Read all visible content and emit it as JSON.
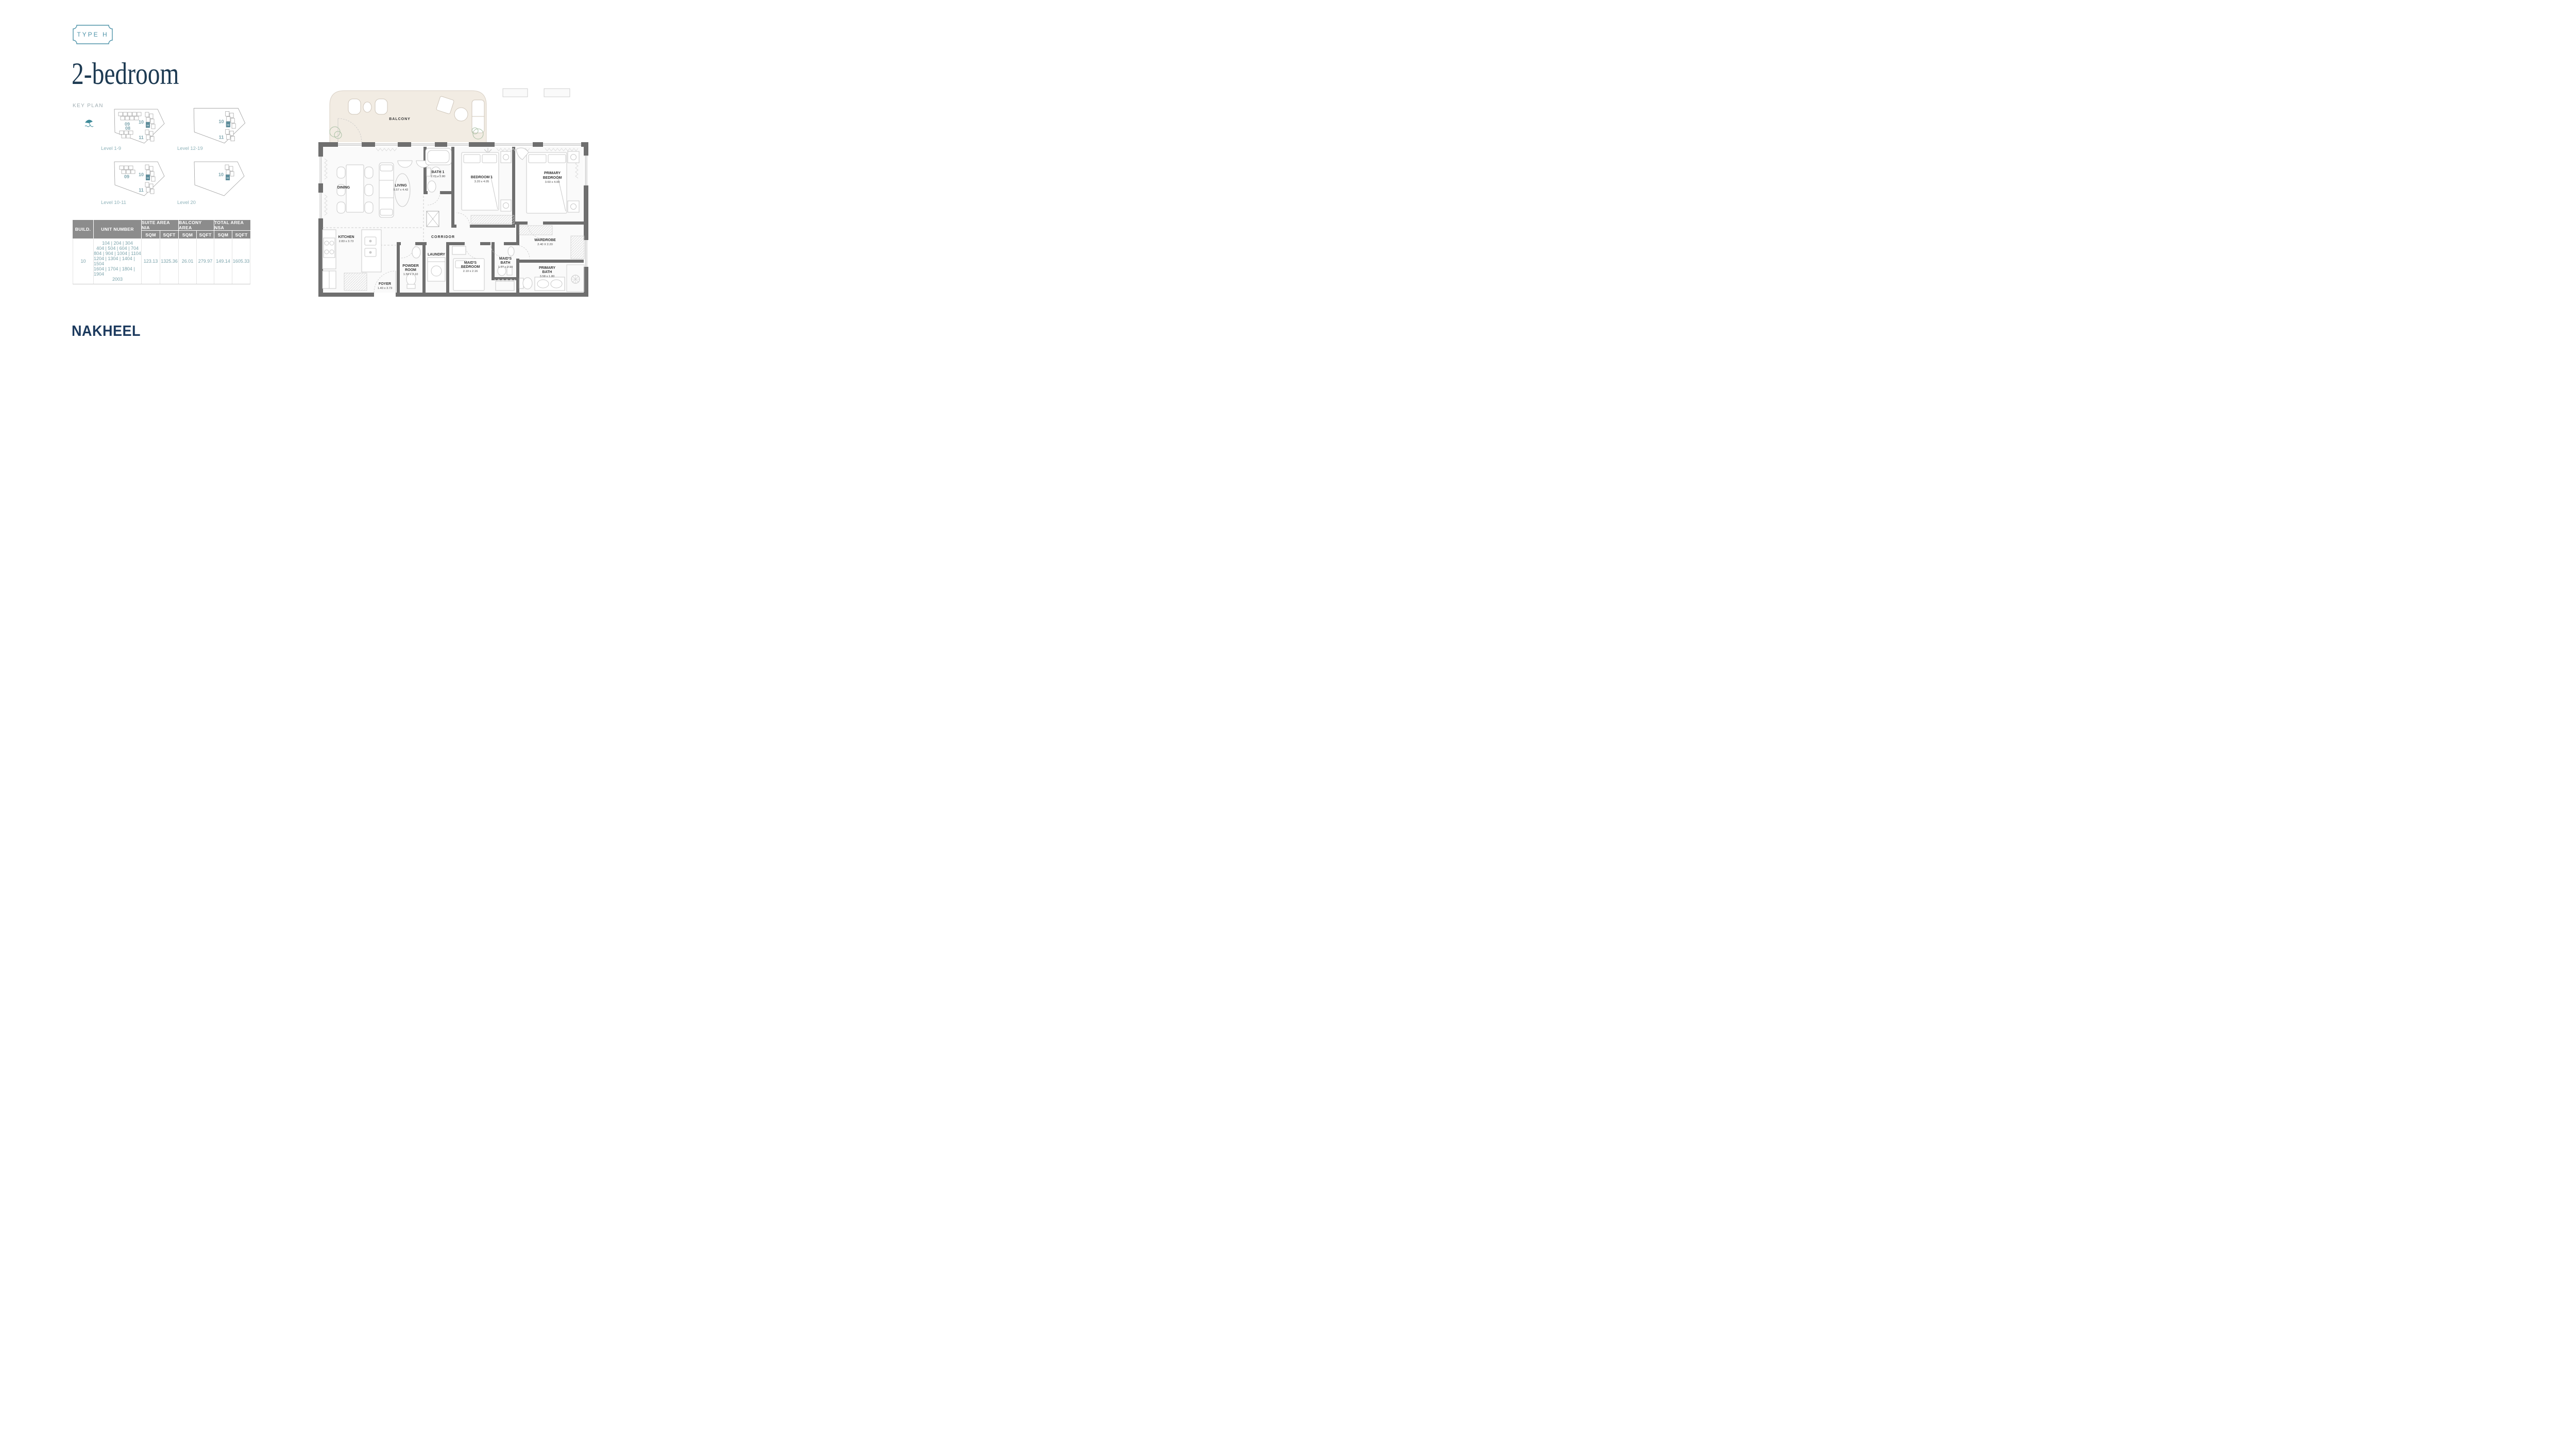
{
  "badge": {
    "label": "TYPE H"
  },
  "title": "2-bedroom",
  "key_plan": {
    "heading": "KEY PLAN",
    "plans": [
      {
        "level_label": "Level 1-9",
        "buildings": [
          "09",
          "10",
          "08",
          "11"
        ],
        "unit": "04"
      },
      {
        "level_label": "Level 12-19",
        "buildings": [
          "10",
          "11"
        ],
        "unit": "04"
      },
      {
        "level_label": "Level 10-11",
        "buildings": [
          "09",
          "10",
          "11"
        ],
        "unit": "04"
      },
      {
        "level_label": "Level 20",
        "buildings": [
          "10"
        ],
        "unit": "03"
      }
    ]
  },
  "table": {
    "build_header": "BUILD.",
    "unit_header": "UNIT NUMBER",
    "groups": [
      "SUITE AREA NIA",
      "BALCONY AREA",
      "TOTAL AREA NSA"
    ],
    "sqm": "SQM",
    "sqft": "SQFT",
    "row": {
      "build": "10",
      "unit_lines": [
        "104 | 204 | 304",
        "404 | 504 | 604 | 704",
        "804 | 904 | 1004 | 1104",
        "1204 | 1304 | 1404 | 1504",
        "1604 | 1704 | 1804 | 1904",
        "2003"
      ],
      "suite_sqm": "123.13",
      "suite_sqft": "1325.36",
      "balcony_sqm": "26.01",
      "balcony_sqft": "279.97",
      "total_sqm": "149.14",
      "total_sqft": "1605.33"
    }
  },
  "floorplan": {
    "rooms": {
      "balcony": {
        "line1": "BALCONY"
      },
      "dining": {
        "line1": "DINING"
      },
      "living": {
        "line1": "LIVING",
        "dims": "5.57 x 4.42"
      },
      "bath1": {
        "line1": "BATH 1",
        "dims": "1.70 x 2.80"
      },
      "bedroom1": {
        "line1": "BEDROOM 1",
        "dims": "3.20 x 4.05"
      },
      "primary_bedroom": {
        "line1": "PRIMARY",
        "line2": "BEDROOM",
        "dims": "3.60 x 4.00"
      },
      "kitchen": {
        "line1": "KITCHEN",
        "dims": "2.83 x 3.73"
      },
      "foyer": {
        "line1": "FOYER",
        "dims": "1.40 x 3.73"
      },
      "powder": {
        "line1": "POWDER",
        "line2": "ROOM",
        "dims": "1.50 x 2.10"
      },
      "laundry": {
        "line1": "LAUNDRY"
      },
      "maid_bedroom": {
        "line1": "MAID'S",
        "line2": "BEDROOM",
        "dims": "2.10 x 2.16"
      },
      "maid_bath": {
        "line1": "MAID'S",
        "line2": "BATH",
        "dims": "1.37 x 2.10"
      },
      "corridor": {
        "line1": "CORRIDOR"
      },
      "wardrobe": {
        "line1": "WARDROBE",
        "dims": "2.40 X 2.20"
      },
      "primary_bath": {
        "line1": "PRIMARY",
        "line2": "BATH",
        "dims": "3.58 x 1.80"
      }
    }
  },
  "logo": {
    "text": "NAKHEEL"
  },
  "colors": {
    "teal_accent": "#4E93A9",
    "navy": "#1D3A52",
    "keyplan_teal": "#7FA6AF",
    "table_header_gray": "#8C8C8C",
    "table_text_teal": "#7AA2AA",
    "wall_gray": "#6F6F6F",
    "balcony_cream": "#F2ECE3",
    "highlight_unit": "#5E8D9B"
  }
}
